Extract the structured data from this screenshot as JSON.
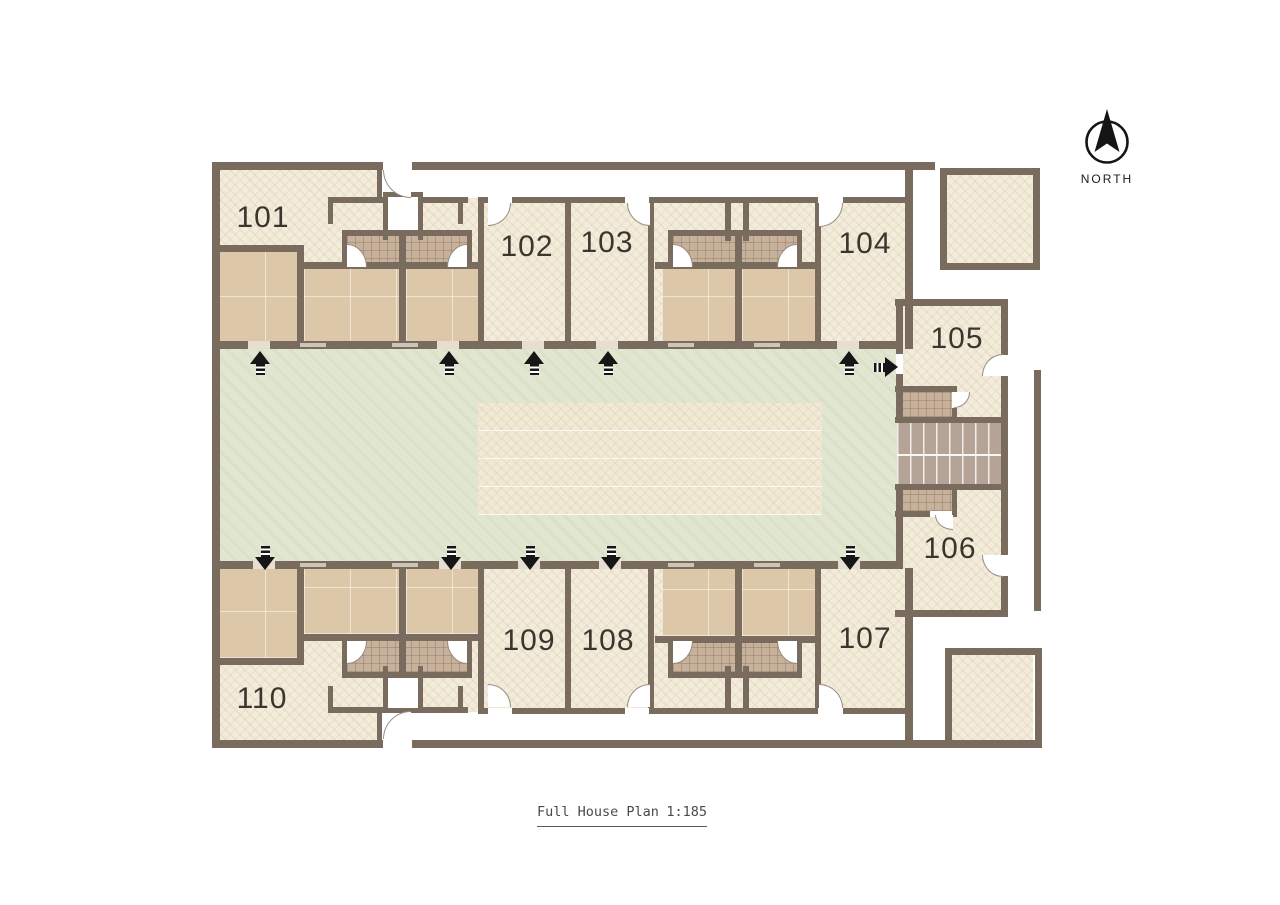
{
  "plan": {
    "title": {
      "text": "Full House Plan",
      "scale": "1:185"
    },
    "north": {
      "label": "NORTH"
    },
    "rooms": [
      {
        "number": "101"
      },
      {
        "number": "102"
      },
      {
        "number": "103"
      },
      {
        "number": "104"
      },
      {
        "number": "105"
      },
      {
        "number": "106"
      },
      {
        "number": "107"
      },
      {
        "number": "108"
      },
      {
        "number": "109"
      },
      {
        "number": "110"
      }
    ],
    "colors": {
      "wall": "#7a6b5f",
      "room_floor": "#f3ecda",
      "bedroom_floor": "#dcc7a9",
      "bathroom_tile": "#c7b19a",
      "stair_block": "#b4a396",
      "courtyard": "#e0e6cf",
      "courtyard_path": "#f2e9d5",
      "arrow": "#161616",
      "label_text": "#3a352f"
    }
  }
}
